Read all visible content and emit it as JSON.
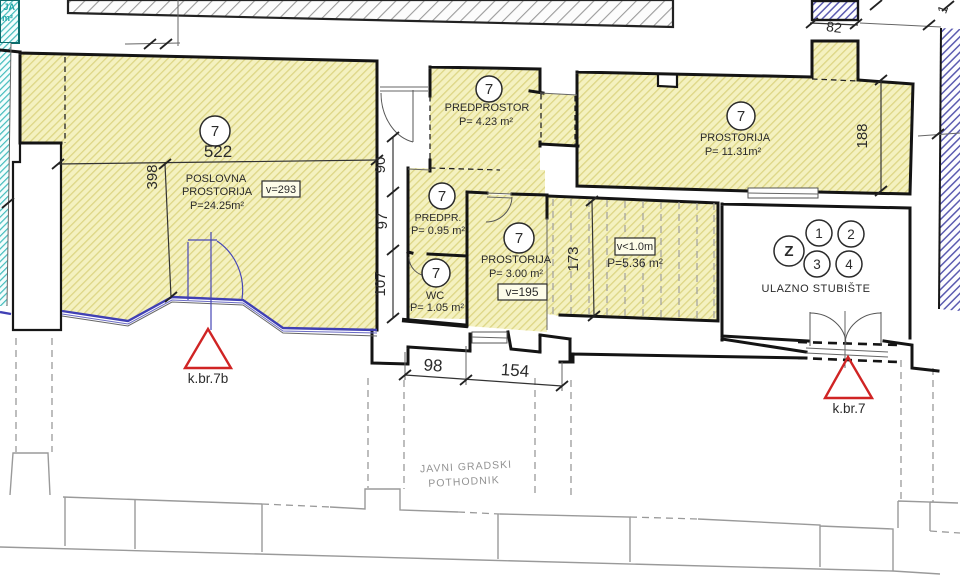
{
  "rooms": {
    "poslovna": {
      "num": "7",
      "line1": "POSLOVNA",
      "line2": "PROSTORIJA",
      "area": "P=24.25m²",
      "vbox": "v=293"
    },
    "predprostor": {
      "num": "7",
      "name": "PREDPROSTOR",
      "area": "P= 4.23 m²"
    },
    "predpr": {
      "num": "7",
      "name": "PREDPR.",
      "area": "P= 0.95 m²"
    },
    "wc": {
      "num": "7",
      "name": "WC",
      "area": "P= 1.05 m²"
    },
    "prostorija3": {
      "num": "7",
      "name": "PROSTORIJA",
      "area": "P= 3.00 m²",
      "vbox": "v=195"
    },
    "under_stairs": {
      "vbox": "v<1.0m",
      "area": "P=5.36 m²"
    },
    "prostorija11": {
      "num": "7",
      "name": "PROSTORIJA",
      "area": "P= 11.31m²"
    },
    "stubiste": {
      "name": "ULAZNO STUBIŠTE",
      "c_z": "Z",
      "c1": "1",
      "c2": "2",
      "c3": "3",
      "c4": "4"
    }
  },
  "dims": {
    "d522": "522",
    "d398": "398",
    "d90": "90",
    "d97": "97",
    "d107": "107",
    "d98": "98",
    "d154": "154",
    "d173": "173",
    "d188": "188",
    "d82": "82",
    "d_part": "1"
  },
  "markers": {
    "left": "k.br.7b",
    "right": "k.br.7"
  },
  "passage": {
    "line1": "JAVNI GRADSKI",
    "line2": "POTHODNIK"
  },
  "corner": {
    "line1": "JA",
    "line2": "m²"
  }
}
